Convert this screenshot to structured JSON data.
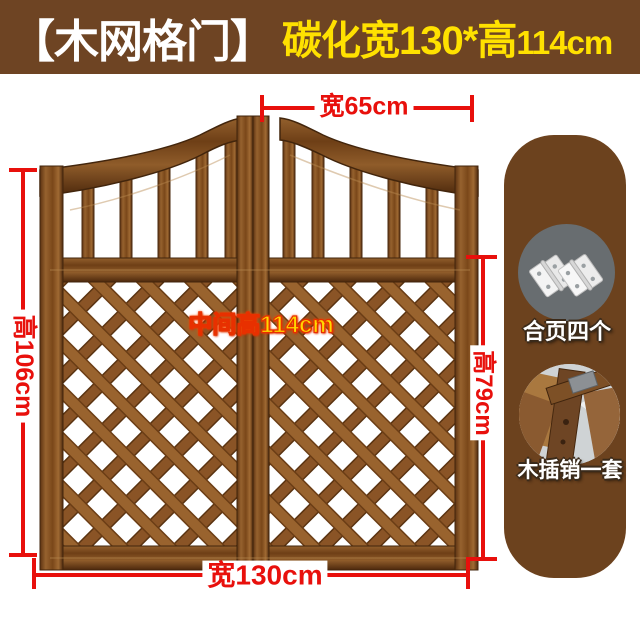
{
  "banner": {
    "title": "【木网格门】",
    "subtitle_main": "碳化宽130*高",
    "subtitle_small": "114cm",
    "bg_color": "#6e4423",
    "title_color": "#ffffff",
    "subtitle_color": "#ffe100"
  },
  "dimensions": {
    "top_door_width": "宽65cm",
    "left_side_height": "高106cm",
    "center_height": "中间高114cm",
    "right_side_height": "高79cm",
    "bottom_total_width": "宽130cm",
    "line_color": "#e8100c",
    "center_label_color": "#ffd800"
  },
  "accessories": {
    "panel_color": "#6c421e",
    "items": [
      {
        "icon": "hinges-photo",
        "label": "合页四个"
      },
      {
        "icon": "wooden-latch-photo",
        "label": "木插销一套"
      }
    ]
  },
  "product": {
    "wood_color": "#7a4a1f"
  }
}
